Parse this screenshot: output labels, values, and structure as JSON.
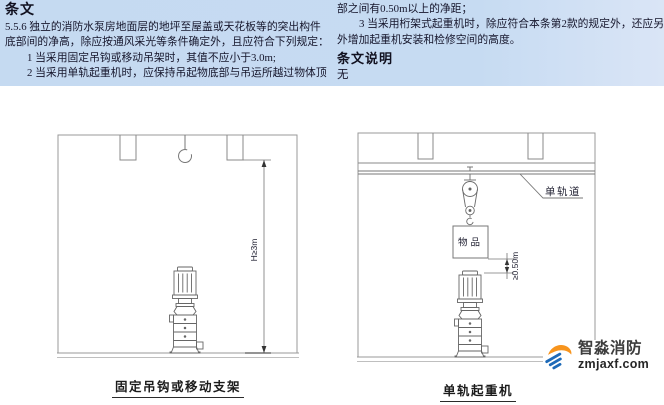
{
  "page": {
    "panel_background": "#c6dbf2",
    "line_color": "#8a8a8a",
    "text_color": "#16162c"
  },
  "article": {
    "heading": "条文",
    "left_lines": [
      "5.5.6 独立的消防水泵房地面层的地坪至屋盖或天花板等的突出构件",
      "底部间的净高，除应按通风采光等条件确定外，且应符合下列规定：",
      "1 当采用固定吊钩或移动吊架时，其值不应小于3.0m;",
      "2 当采用单轨起重机时，应保持吊起物底部与吊运所越过物体顶"
    ],
    "right_lines": [
      "部之间有0.50m以上的净距；",
      "3 当采用桁架式起重机时，除应符合本条第2款的规定外，还应另",
      "外增加起重机安装和检修空间的高度。"
    ],
    "explanation_heading": "条文说明",
    "explanation_body": "无"
  },
  "figures": {
    "left": {
      "caption": "固定吊钩或移动支架",
      "height_dim_label": "H≥3m"
    },
    "right": {
      "caption": "单轨起重机",
      "rail_label": "单轨道",
      "load_box_label": "物品",
      "clearance_dim_label": "≥0.50m"
    }
  },
  "logo": {
    "brand_name": "智淼消防",
    "website": "zmjaxf.com",
    "accent_orange": "#f7941d",
    "accent_blue": "#1d6ab8"
  }
}
